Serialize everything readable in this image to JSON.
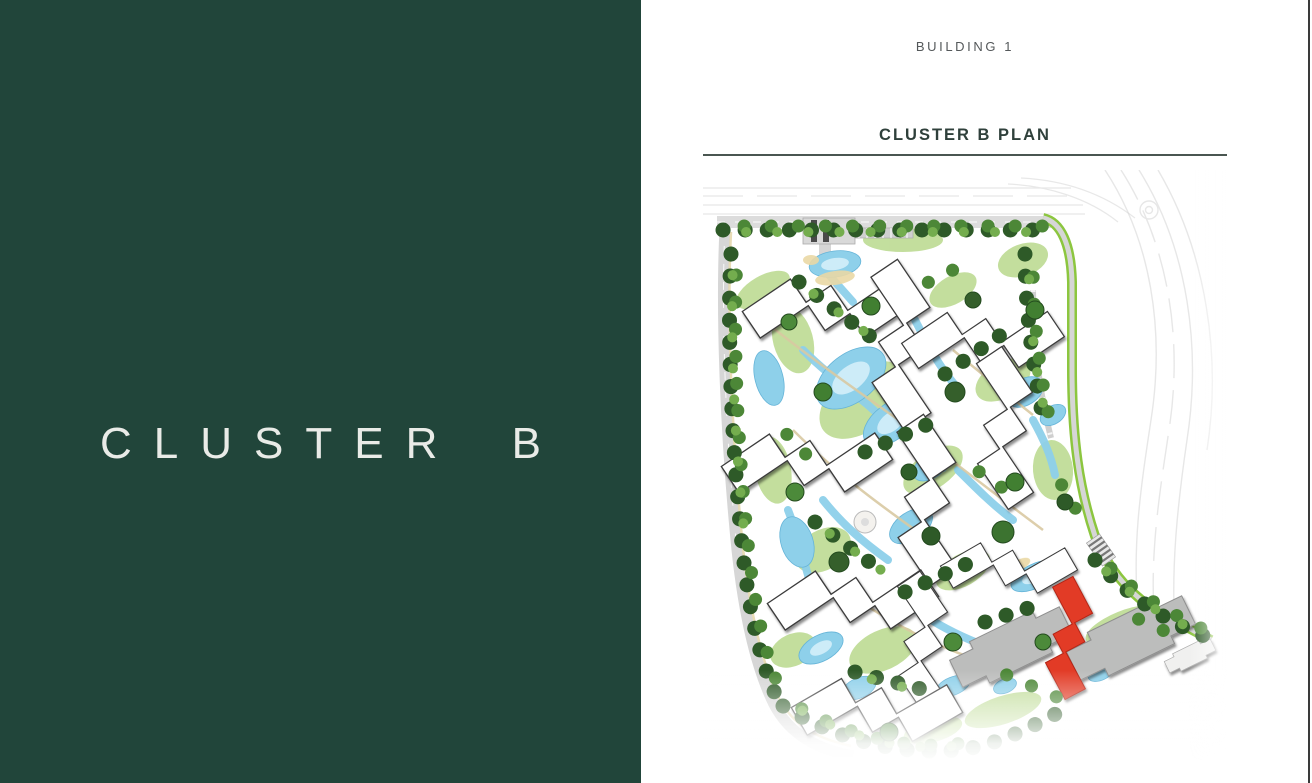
{
  "left_panel": {
    "title": "CLUSTER B",
    "background": "#21453a",
    "text_color": "#e9ebe7"
  },
  "right_panel": {
    "eyebrow": "BUILDING 1",
    "heading": "CLUSTER B PLAN",
    "heading_color": "#2f403b",
    "rule_color": "#4a5651"
  },
  "map": {
    "label": "Cluster B master plan illustration with Building 1 highlighted in red",
    "highlighted_building": "Building 1",
    "colors": {
      "highlight": "#e23b28",
      "building": "#ffffff",
      "building_outline": "#3b3b3b",
      "neighbor_building": "#bcbdbc",
      "water": "#8ed0ea",
      "water_light": "#cdecf8",
      "tree_dark": "#2e5a28",
      "tree_mid": "#4c8737",
      "tree_light": "#74ad4e",
      "grass": "#8cc63f",
      "lawn": "#b9d98d",
      "road": "#d6d6d6",
      "sand": "#ead9a5",
      "walkway": "#d9c9a2"
    }
  }
}
